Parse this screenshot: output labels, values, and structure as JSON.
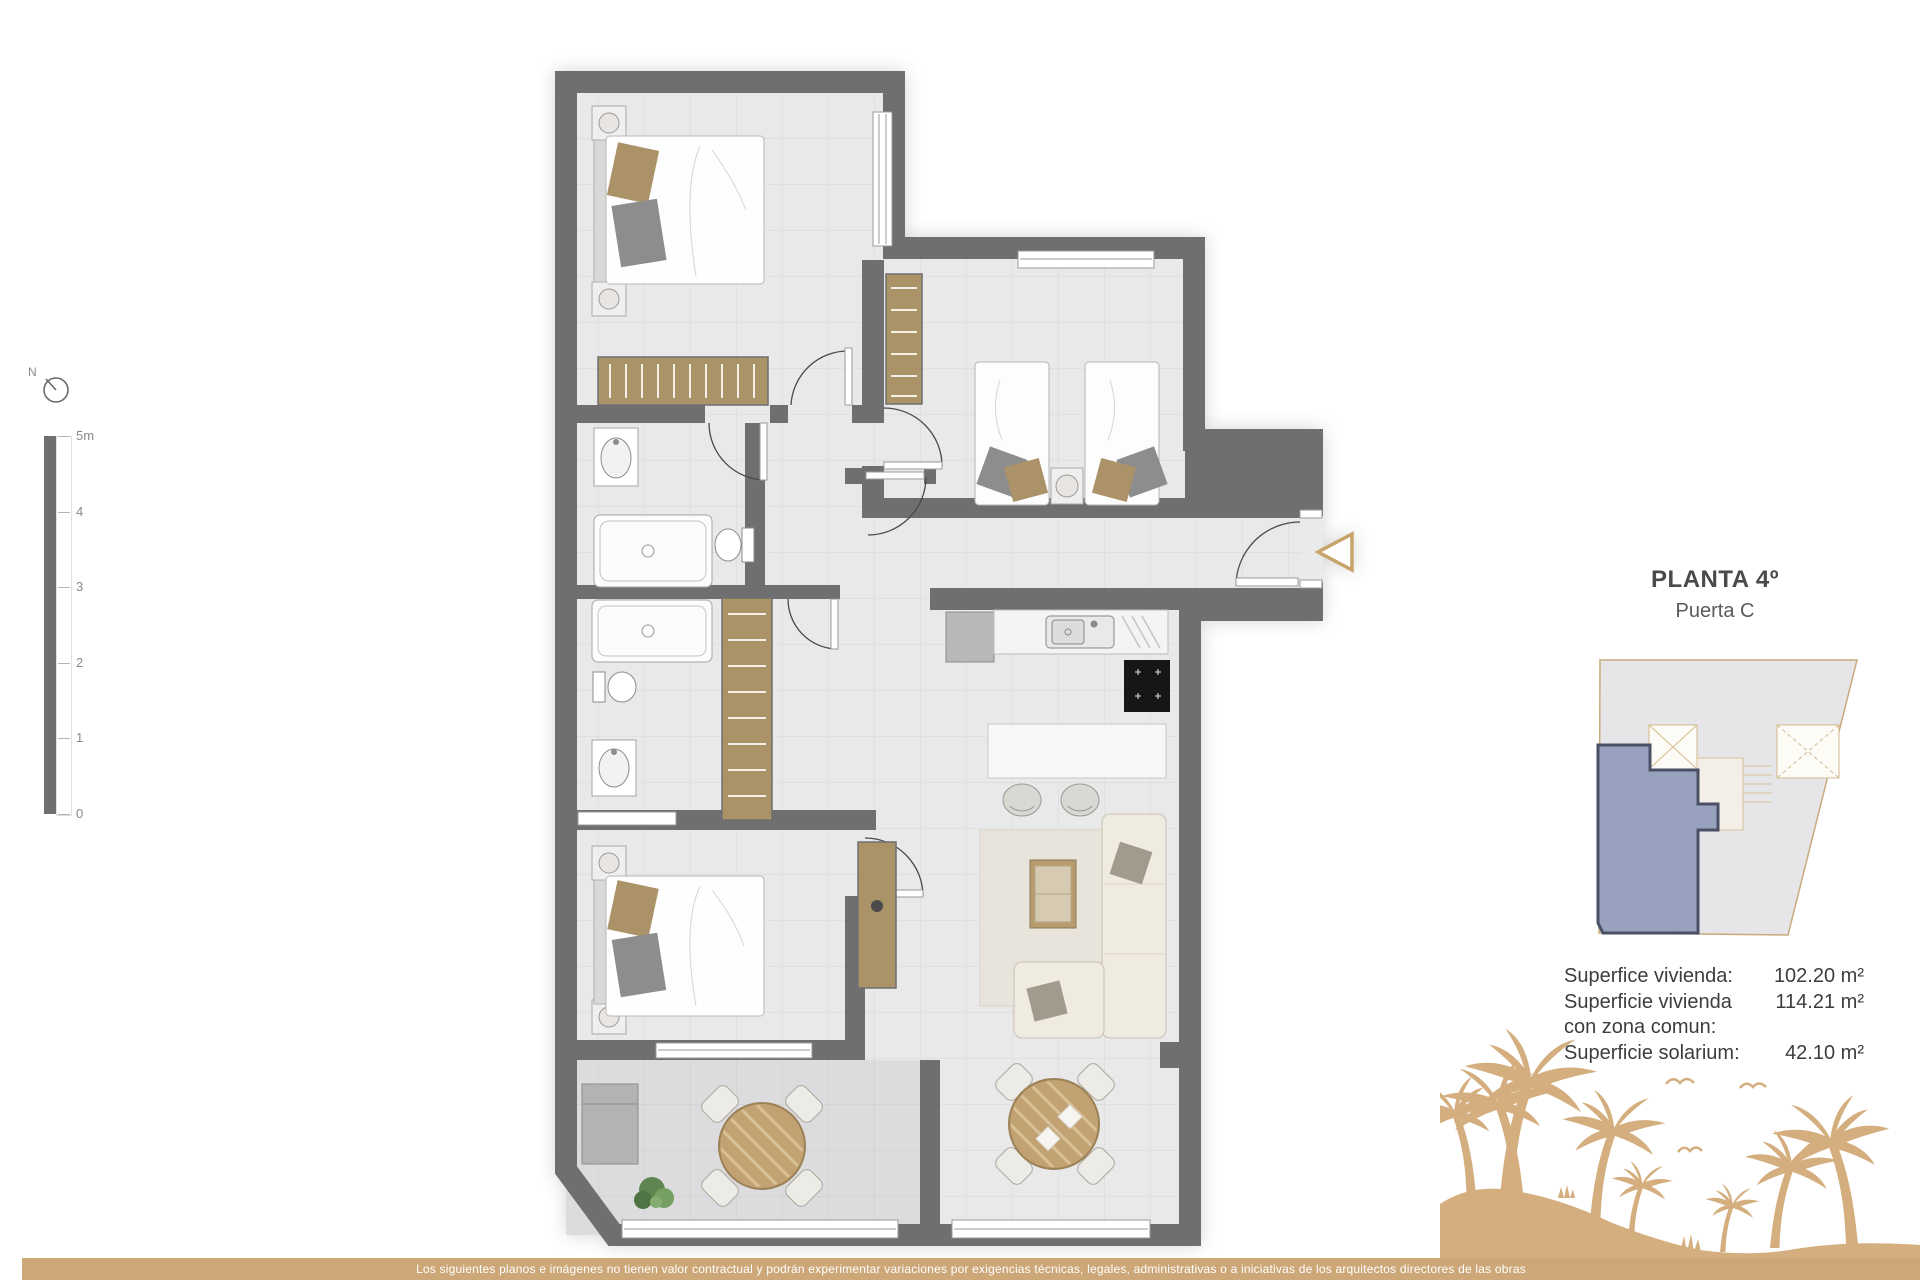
{
  "title": {
    "floor": "PLANTA 4º",
    "unit": "Puerta C"
  },
  "compass": {
    "north_label": "N"
  },
  "scale_bar": {
    "labels": [
      "5m",
      "4",
      "3",
      "2",
      "1",
      "0"
    ]
  },
  "surfaces": {
    "rows": [
      {
        "label": "Superfice vivienda:",
        "value": "102.20 m²"
      },
      {
        "label": "Superficie vivienda con zona comun:",
        "value": "114.21 m²"
      },
      {
        "label": "Superficie solarium:",
        "value": "42.10 m²"
      }
    ]
  },
  "footer": {
    "disclaimer": "Los siguientes planos e imágenes no tienen valor contractual y podrán experimentar variaciones por exigencias técnicas, legales, administrativas o a iniciativas de los arquitectos directores de las obras"
  },
  "colors": {
    "wall_gray": "#6f6f71",
    "floor_light": "#e9e9ea",
    "terrace_floor": "#dddddf",
    "wood_tan": "#ab9368",
    "accent_tan": "#cda778",
    "palm_tan": "#d4ae7e",
    "unit_highlight": "#98a2bf",
    "keyplan_outline": "#c9aa7c"
  }
}
